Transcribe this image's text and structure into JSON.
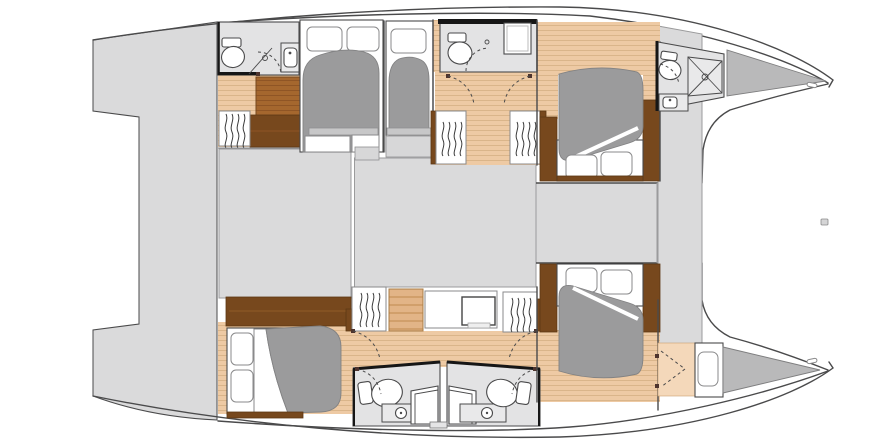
{
  "meta": {
    "type": "yacht-floor-plan",
    "vessel": "catamaran",
    "view": "overhead-interior-layout",
    "text_on_image": "none"
  },
  "colors": {
    "bg": "#ffffff",
    "outline": "#4a4a4b",
    "wall": "#161616",
    "deck": "#dadadb",
    "deck_line": "#9b9b9c",
    "room": "#e3e3e4",
    "floor_tan": "#eecaa4",
    "plank": "#dab58a",
    "floor_salmon": "#f4d8ba",
    "brown_dark": "#77481d",
    "brown_mid": "#a5672e",
    "brown_mid_line": "#8f5525",
    "chest": "#e2b487",
    "chest_line": "#c08a4f",
    "mattress": "#9b9b9c",
    "mattress_line": "#828283",
    "white": "#ffffff",
    "fixture": "#e9e9ea",
    "triangle": "#b9b9ba",
    "pivot": "#4e342e"
  },
  "layout": {
    "center_sections": [
      "aft-platform",
      "saloon-aft",
      "saloon-forward",
      "forward-cockpit",
      "foredeck-beam"
    ],
    "port_hull_rooms": [
      "aft-head",
      "aft-double-cabin",
      "aft-single-cabin",
      "mid-head",
      "corridor-wardrobes",
      "forward-cabin",
      "forward-head",
      "forepeak-locker"
    ],
    "starboard_hull_rooms": [
      "aft-cabin",
      "corridor-desk-wardrobes",
      "twin-heads",
      "forward-cabin",
      "forward-locker",
      "forepeak-locker"
    ],
    "fixture_kinds": [
      "toilet",
      "sink",
      "shower",
      "double-bed",
      "pillow",
      "wardrobe-hangers",
      "drawer-chest",
      "desk",
      "steps",
      "door-swing"
    ]
  }
}
